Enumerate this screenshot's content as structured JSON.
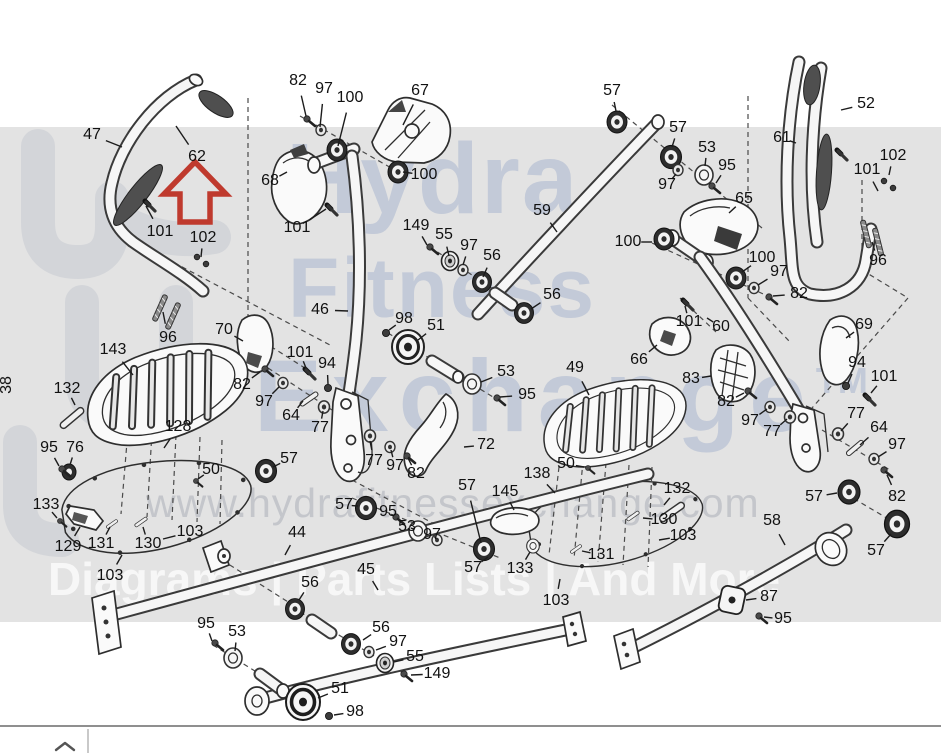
{
  "watermark": {
    "word1": "Hydra",
    "word2": "Fitness",
    "word3": "Exchange",
    "trademark": "TM",
    "url": "www.hydrafitnessexchange.com",
    "tagline": "Diagrams | Parts Lists | And More"
  },
  "highlight": {
    "part": "62",
    "marker": "red-arrow",
    "color": "#bf3a2e"
  },
  "sheet_note": "38",
  "colors": {
    "background": "#ffffff",
    "band": "#e3e3e3",
    "line": "#2e2e2e",
    "label_text": "#111111",
    "watermark_text": "#96a8c8",
    "arrow_red": "#bf3a2e"
  },
  "footer": {
    "icon": "chevron-up"
  },
  "diagram": {
    "labels": [
      {
        "t": "47",
        "x": 92,
        "y": 135,
        "lx": 122,
        "ly": 147
      },
      {
        "t": "62",
        "x": 197,
        "y": 157,
        "lx": 176,
        "ly": 126
      },
      {
        "t": "101",
        "x": 160,
        "y": 232,
        "lx": 146,
        "ly": 206
      },
      {
        "t": "102",
        "x": 203,
        "y": 238,
        "lx": 201,
        "ly": 257
      },
      {
        "t": "96",
        "x": 168,
        "y": 338,
        "lx": 163,
        "ly": 312
      },
      {
        "t": "70",
        "x": 224,
        "y": 330,
        "lx": 243,
        "ly": 341
      },
      {
        "t": "143",
        "x": 113,
        "y": 350,
        "lx": 133,
        "ly": 375
      },
      {
        "t": "132",
        "x": 67,
        "y": 389,
        "lx": 75,
        "ly": 405
      },
      {
        "t": "38",
        "x": 7,
        "y": 385,
        "rot": true
      },
      {
        "t": "82",
        "x": 298,
        "y": 81,
        "lx": 306,
        "ly": 116
      },
      {
        "t": "97",
        "x": 324,
        "y": 89,
        "lx": 320,
        "ly": 127
      },
      {
        "t": "100",
        "x": 350,
        "y": 98,
        "lx": 338,
        "ly": 146
      },
      {
        "t": "67",
        "x": 420,
        "y": 91,
        "lx": 403,
        "ly": 125
      },
      {
        "t": "68",
        "x": 270,
        "y": 181,
        "lx": 287,
        "ly": 172
      },
      {
        "t": "100",
        "x": 424,
        "y": 175,
        "lx": 403,
        "ly": 172
      },
      {
        "t": "101",
        "x": 297,
        "y": 228,
        "lx": 326,
        "ly": 209
      },
      {
        "t": "149",
        "x": 416,
        "y": 226,
        "lx": 427,
        "ly": 245
      },
      {
        "t": "55",
        "x": 444,
        "y": 235,
        "lx": 449,
        "ly": 256
      },
      {
        "t": "97",
        "x": 469,
        "y": 246,
        "lx": 463,
        "ly": 265
      },
      {
        "t": "56",
        "x": 492,
        "y": 256,
        "lx": 483,
        "ly": 277
      },
      {
        "t": "59",
        "x": 542,
        "y": 211,
        "lx": 557,
        "ly": 232
      },
      {
        "t": "46",
        "x": 320,
        "y": 310,
        "lx": 348,
        "ly": 311
      },
      {
        "t": "98",
        "x": 404,
        "y": 319,
        "lx": 389,
        "ly": 330
      },
      {
        "t": "51",
        "x": 436,
        "y": 326,
        "lx": 418,
        "ly": 340
      },
      {
        "t": "56",
        "x": 552,
        "y": 295,
        "lx": 531,
        "ly": 309
      },
      {
        "t": "57",
        "x": 612,
        "y": 91,
        "lx": 616,
        "ly": 111
      },
      {
        "t": "57",
        "x": 678,
        "y": 128,
        "lx": 672,
        "ly": 147
      },
      {
        "t": "53",
        "x": 707,
        "y": 148,
        "lx": 705,
        "ly": 166
      },
      {
        "t": "95",
        "x": 727,
        "y": 166,
        "lx": 716,
        "ly": 183
      },
      {
        "t": "97",
        "x": 667,
        "y": 185,
        "lx": 676,
        "ly": 174
      },
      {
        "t": "65",
        "x": 744,
        "y": 199,
        "lx": 729,
        "ly": 213
      },
      {
        "t": "52",
        "x": 866,
        "y": 104,
        "lx": 841,
        "ly": 110
      },
      {
        "t": "61",
        "x": 782,
        "y": 138,
        "lx": 796,
        "ly": 143
      },
      {
        "t": "102",
        "x": 893,
        "y": 156,
        "lx": 889,
        "ly": 175
      },
      {
        "t": "101",
        "x": 867,
        "y": 170,
        "lx": 878,
        "ly": 191
      },
      {
        "t": "96",
        "x": 878,
        "y": 261,
        "lx": 872,
        "ly": 242
      },
      {
        "t": "100",
        "x": 628,
        "y": 242,
        "lx": 652,
        "ly": 242
      },
      {
        "t": "100",
        "x": 762,
        "y": 258,
        "lx": 742,
        "ly": 272
      },
      {
        "t": "97",
        "x": 779,
        "y": 272,
        "lx": 758,
        "ly": 285
      },
      {
        "t": "82",
        "x": 799,
        "y": 294,
        "lx": 773,
        "ly": 296
      },
      {
        "t": "101",
        "x": 689,
        "y": 322,
        "lx": 685,
        "ly": 306
      },
      {
        "t": "60",
        "x": 721,
        "y": 327,
        "lx": 707,
        "ly": 318
      },
      {
        "t": "66",
        "x": 639,
        "y": 360,
        "lx": 657,
        "ly": 345
      },
      {
        "t": "69",
        "x": 864,
        "y": 325,
        "lx": 846,
        "ly": 338
      },
      {
        "t": "83",
        "x": 691,
        "y": 379,
        "lx": 711,
        "ly": 376
      },
      {
        "t": "94",
        "x": 857,
        "y": 363,
        "lx": 848,
        "ly": 383
      },
      {
        "t": "101",
        "x": 884,
        "y": 377,
        "lx": 871,
        "ly": 393
      },
      {
        "t": "82",
        "x": 726,
        "y": 402,
        "lx": 744,
        "ly": 393
      },
      {
        "t": "97",
        "x": 750,
        "y": 421,
        "lx": 767,
        "ly": 409
      },
      {
        "t": "77",
        "x": 772,
        "y": 432,
        "lx": 787,
        "ly": 419
      },
      {
        "t": "77",
        "x": 856,
        "y": 414,
        "lx": 841,
        "ly": 431
      },
      {
        "t": "64",
        "x": 879,
        "y": 428,
        "lx": 860,
        "ly": 445
      },
      {
        "t": "97",
        "x": 897,
        "y": 445,
        "lx": 878,
        "ly": 457
      },
      {
        "t": "82",
        "x": 897,
        "y": 497,
        "lx": 887,
        "ly": 475
      },
      {
        "t": "57",
        "x": 814,
        "y": 497,
        "lx": 837,
        "ly": 493
      },
      {
        "t": "57",
        "x": 876,
        "y": 551,
        "lx": 891,
        "ly": 534
      },
      {
        "t": "58",
        "x": 772,
        "y": 521,
        "lx": 785,
        "ly": 545
      },
      {
        "t": "82",
        "x": 242,
        "y": 385,
        "lx": 260,
        "ly": 372
      },
      {
        "t": "101",
        "x": 300,
        "y": 353,
        "lx": 306,
        "ly": 368
      },
      {
        "t": "97",
        "x": 264,
        "y": 402,
        "lx": 279,
        "ly": 387
      },
      {
        "t": "94",
        "x": 327,
        "y": 364,
        "lx": 328,
        "ly": 384
      },
      {
        "t": "64",
        "x": 291,
        "y": 416,
        "lx": 303,
        "ly": 401
      },
      {
        "t": "77",
        "x": 320,
        "y": 428,
        "lx": 323,
        "ly": 411
      },
      {
        "t": "128",
        "x": 178,
        "y": 427,
        "lx": 164,
        "ly": 448
      },
      {
        "t": "95",
        "x": 49,
        "y": 448,
        "lx": 59,
        "ly": 466
      },
      {
        "t": "76",
        "x": 75,
        "y": 448,
        "lx": 70,
        "ly": 465
      },
      {
        "t": "50",
        "x": 211,
        "y": 470,
        "lx": 198,
        "ly": 479
      },
      {
        "t": "57",
        "x": 289,
        "y": 459,
        "lx": 273,
        "ly": 467
      },
      {
        "t": "133",
        "x": 46,
        "y": 505,
        "lx": 57,
        "ly": 518
      },
      {
        "t": "129",
        "x": 68,
        "y": 547,
        "lx": 80,
        "ly": 527
      },
      {
        "t": "131",
        "x": 101,
        "y": 544,
        "lx": 110,
        "ly": 527
      },
      {
        "t": "130",
        "x": 148,
        "y": 544,
        "lx": 143,
        "ly": 527
      },
      {
        "t": "103",
        "x": 190,
        "y": 532,
        "lx": 163,
        "ly": 539
      },
      {
        "t": "103",
        "x": 110,
        "y": 576,
        "lx": 122,
        "ly": 555
      },
      {
        "t": "44",
        "x": 297,
        "y": 533,
        "lx": 285,
        "ly": 555
      },
      {
        "t": "53",
        "x": 506,
        "y": 372,
        "lx": 481,
        "ly": 382
      },
      {
        "t": "95",
        "x": 527,
        "y": 395,
        "lx": 500,
        "ly": 397
      },
      {
        "t": "72",
        "x": 486,
        "y": 445,
        "lx": 464,
        "ly": 447
      },
      {
        "t": "77",
        "x": 374,
        "y": 461,
        "lx": 370,
        "ly": 441
      },
      {
        "t": "97",
        "x": 395,
        "y": 466,
        "lx": 391,
        "ly": 450
      },
      {
        "t": "82",
        "x": 416,
        "y": 474,
        "lx": 408,
        "ly": 458
      },
      {
        "t": "57",
        "x": 344,
        "y": 505,
        "lx": 358,
        "ly": 506
      },
      {
        "t": "95",
        "x": 388,
        "y": 512,
        "lx": 394,
        "ly": 516
      },
      {
        "t": "53",
        "x": 407,
        "y": 527,
        "lx": 414,
        "ly": 529
      },
      {
        "t": "97",
        "x": 432,
        "y": 535,
        "lx": 436,
        "ly": 538
      },
      {
        "t": "57",
        "x": 467,
        "y": 486,
        "lx": 481,
        "ly": 543
      },
      {
        "t": "49",
        "x": 575,
        "y": 368,
        "lx": 589,
        "ly": 395
      },
      {
        "t": "50",
        "x": 566,
        "y": 464,
        "lx": 584,
        "ly": 467
      },
      {
        "t": "138",
        "x": 537,
        "y": 474,
        "lx": 555,
        "ly": 493
      },
      {
        "t": "145",
        "x": 505,
        "y": 492,
        "lx": 514,
        "ly": 510
      },
      {
        "t": "132",
        "x": 677,
        "y": 489,
        "lx": 664,
        "ly": 505
      },
      {
        "t": "130",
        "x": 664,
        "y": 520,
        "lx": 643,
        "ly": 518
      },
      {
        "t": "103",
        "x": 683,
        "y": 536,
        "lx": 659,
        "ly": 540
      },
      {
        "t": "131",
        "x": 601,
        "y": 555,
        "lx": 582,
        "ly": 551
      },
      {
        "t": "133",
        "x": 520,
        "y": 569,
        "lx": 530,
        "ly": 552
      },
      {
        "t": "103",
        "x": 556,
        "y": 601,
        "lx": 560,
        "ly": 579
      },
      {
        "t": "57",
        "x": 473,
        "y": 568,
        "lx": 488,
        "ly": 557
      },
      {
        "t": "56",
        "x": 310,
        "y": 583,
        "lx": 299,
        "ly": 600
      },
      {
        "t": "45",
        "x": 366,
        "y": 570,
        "lx": 378,
        "ly": 590
      },
      {
        "t": "56",
        "x": 381,
        "y": 628,
        "lx": 363,
        "ly": 640
      },
      {
        "t": "97",
        "x": 398,
        "y": 642,
        "lx": 376,
        "ly": 650
      },
      {
        "t": "55",
        "x": 415,
        "y": 657,
        "lx": 394,
        "ly": 662
      },
      {
        "t": "149",
        "x": 437,
        "y": 674,
        "lx": 411,
        "ly": 675
      },
      {
        "t": "51",
        "x": 340,
        "y": 689,
        "lx": 318,
        "ly": 698
      },
      {
        "t": "98",
        "x": 355,
        "y": 712,
        "lx": 334,
        "ly": 715
      },
      {
        "t": "95",
        "x": 206,
        "y": 624,
        "lx": 212,
        "ly": 641
      },
      {
        "t": "53",
        "x": 237,
        "y": 632,
        "lx": 235,
        "ly": 651
      },
      {
        "t": "87",
        "x": 769,
        "y": 597,
        "lx": 746,
        "ly": 600
      },
      {
        "t": "95",
        "x": 783,
        "y": 619,
        "lx": 764,
        "ly": 617
      }
    ]
  }
}
